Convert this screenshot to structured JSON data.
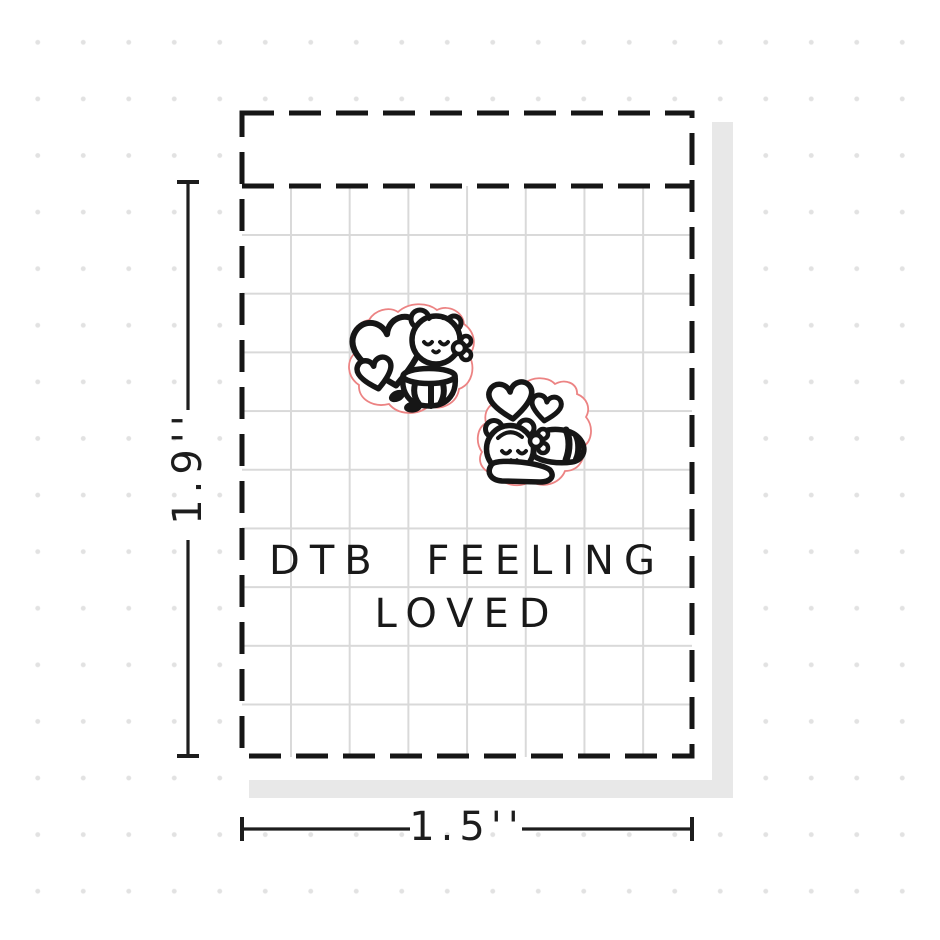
{
  "title": {
    "line1": "DTB FEELING",
    "line2": "LOVED"
  },
  "dimensions": {
    "height_label": "1.9''",
    "width_label": "1.5''"
  },
  "stickers": [
    {
      "name": "bear-hugging-heart-sticker"
    },
    {
      "name": "bear-lying-with-hearts-sticker"
    }
  ],
  "colors": {
    "ink": "#161616",
    "diecut": "#ec8383",
    "grid_line": "#d9d9d9",
    "shadow": "#e8e8e8",
    "dots": "#e2e2e2",
    "paper": "#ffffff"
  }
}
